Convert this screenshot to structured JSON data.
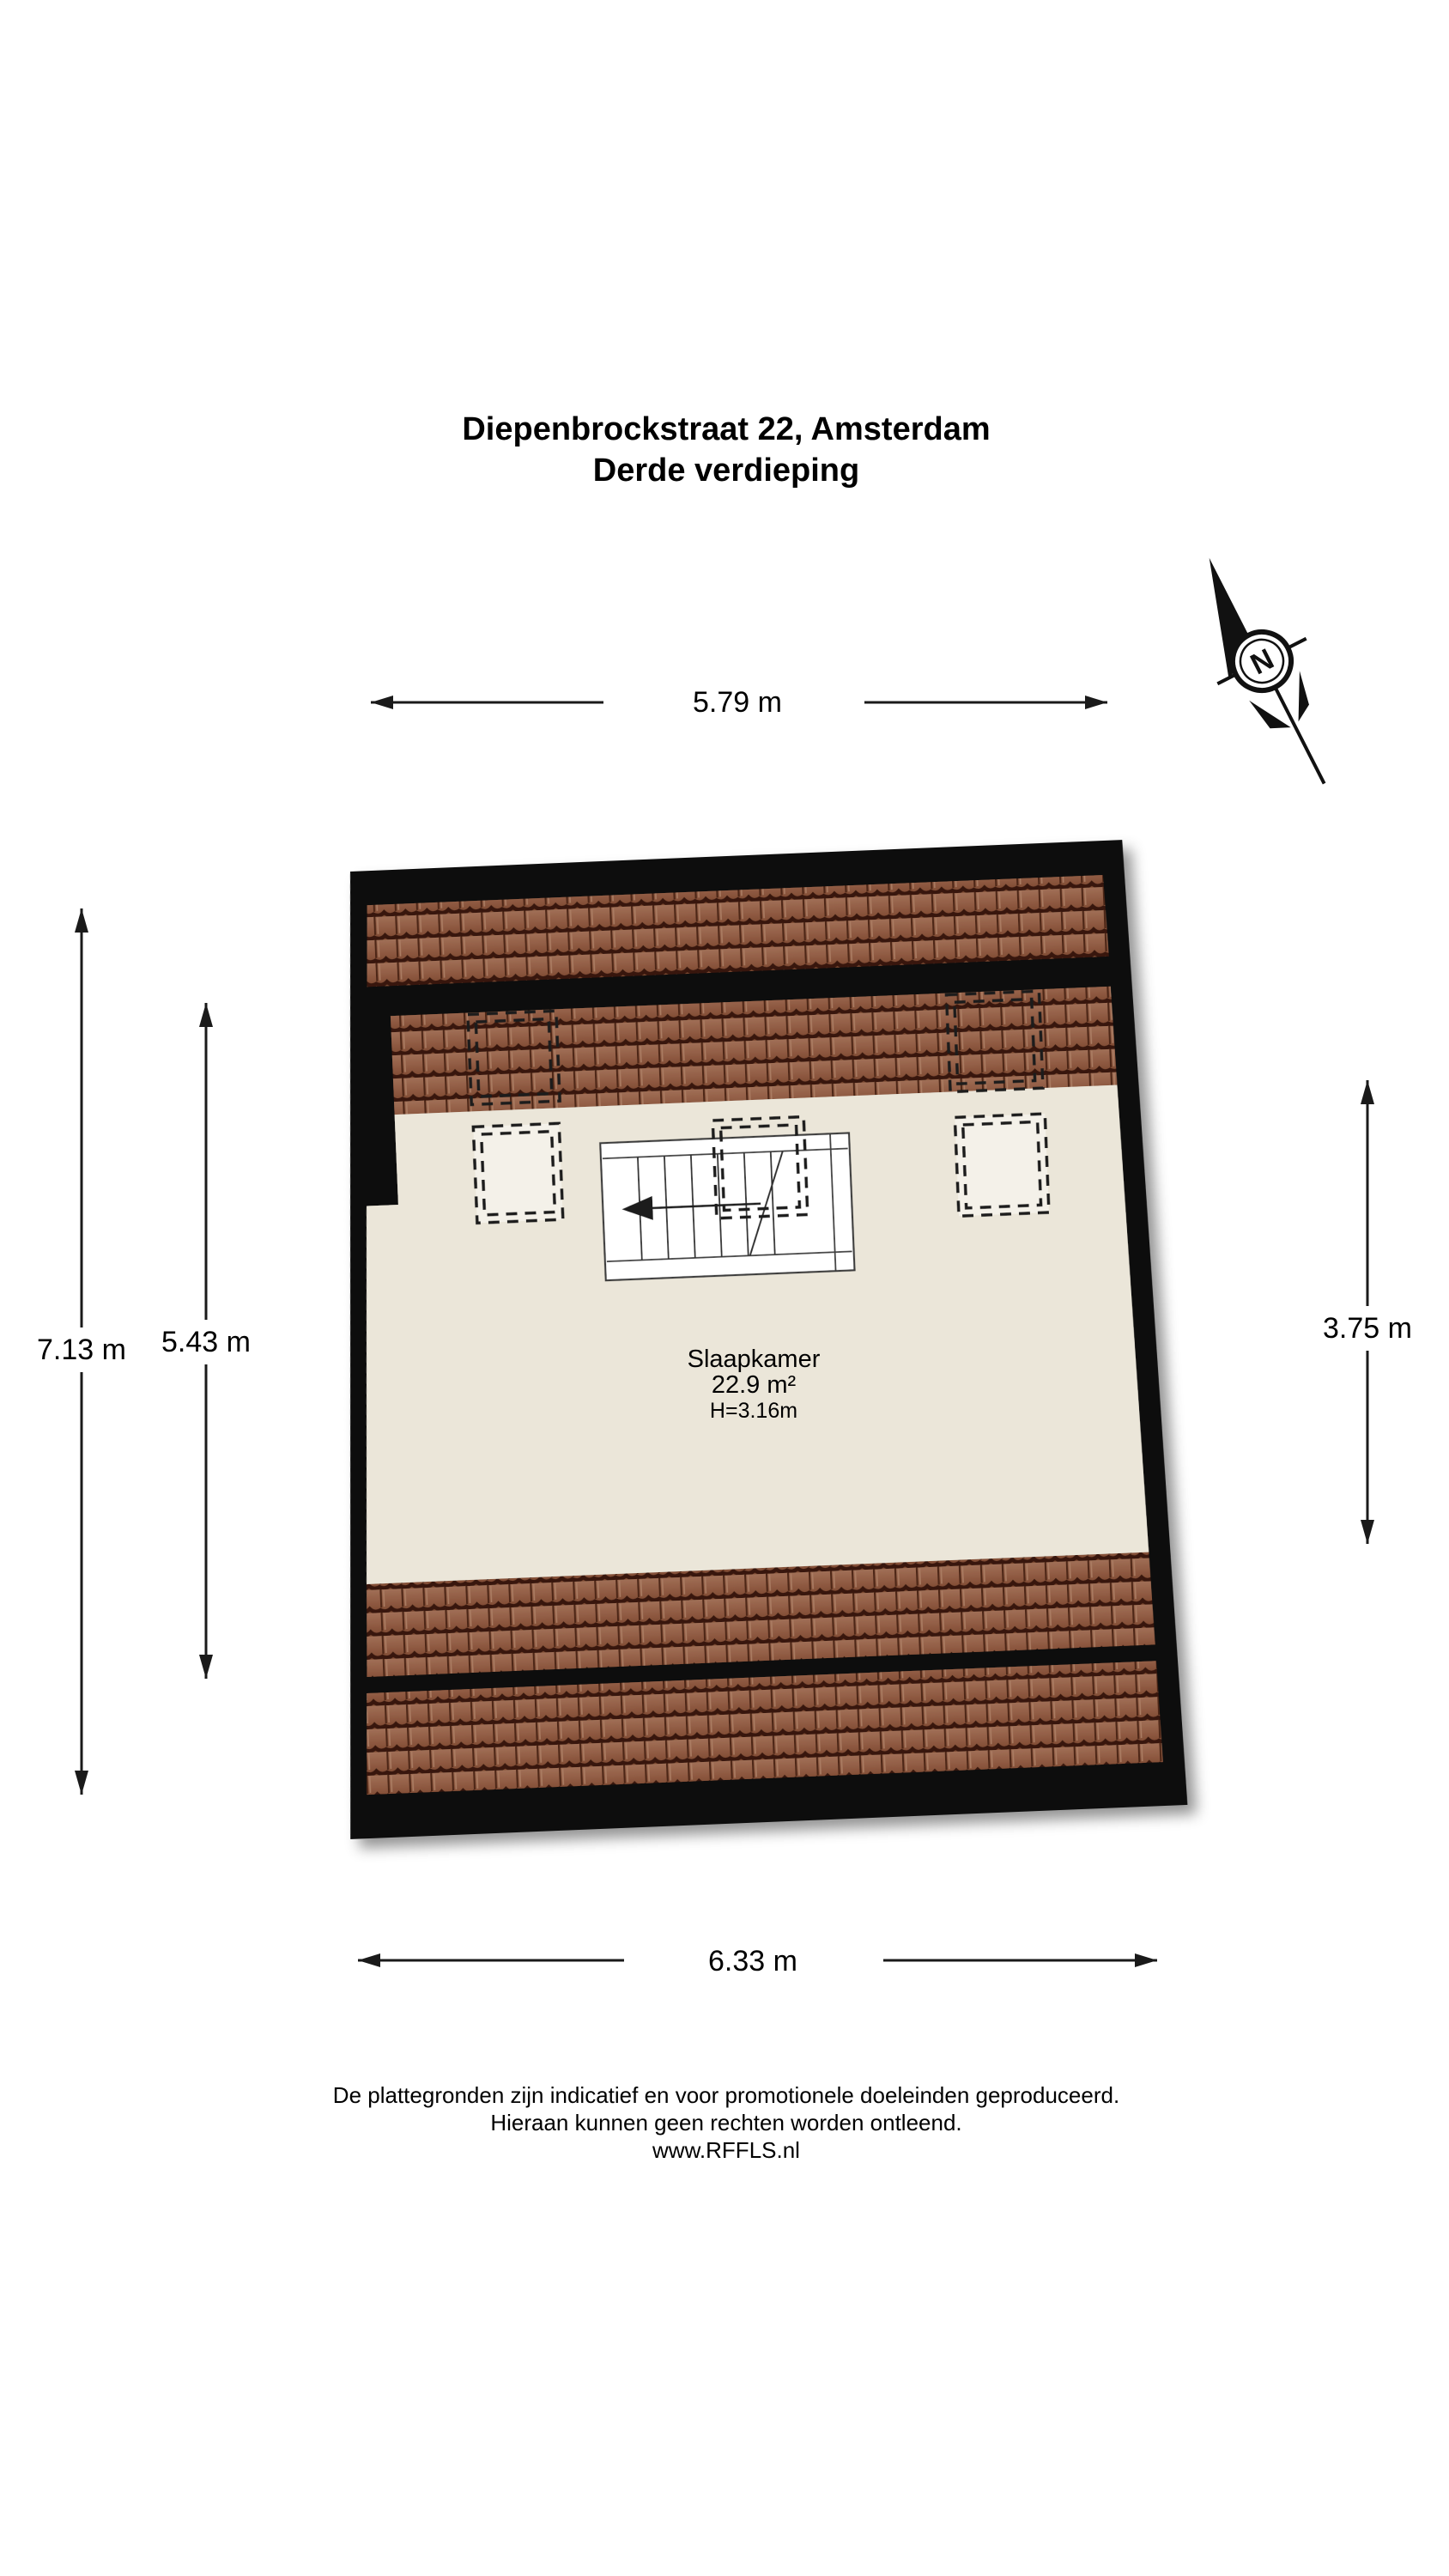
{
  "header": {
    "title_line1": "Diepenbrockstraat 22, Amsterdam",
    "title_line2": "Derde verdieping"
  },
  "floorplan": {
    "room": {
      "name": "Slaapkamer",
      "area": "22.9 m²",
      "height": "H=3.16m"
    },
    "dimensions": {
      "top": "5.79 m",
      "bottom": "6.33 m",
      "left_outer": "7.13 m",
      "left_inner": "5.43 m",
      "right": "3.75 m"
    },
    "compass": {
      "north_label": "N"
    },
    "colors": {
      "wall": "#0c0c0c",
      "floor": "#ebe6d9",
      "roof_tile": "#94604a",
      "roof_tile_shadow": "#38190e",
      "dashed_outline": "#1c1c1c",
      "stair_fill": "#ffffff"
    }
  },
  "footer": {
    "line1": "De plattegronden zijn indicatief en voor promotionele doeleinden geproduceerd.",
    "line2": "Hieraan kunnen geen rechten worden ontleend.",
    "line3": "www.RFFLS.nl"
  }
}
